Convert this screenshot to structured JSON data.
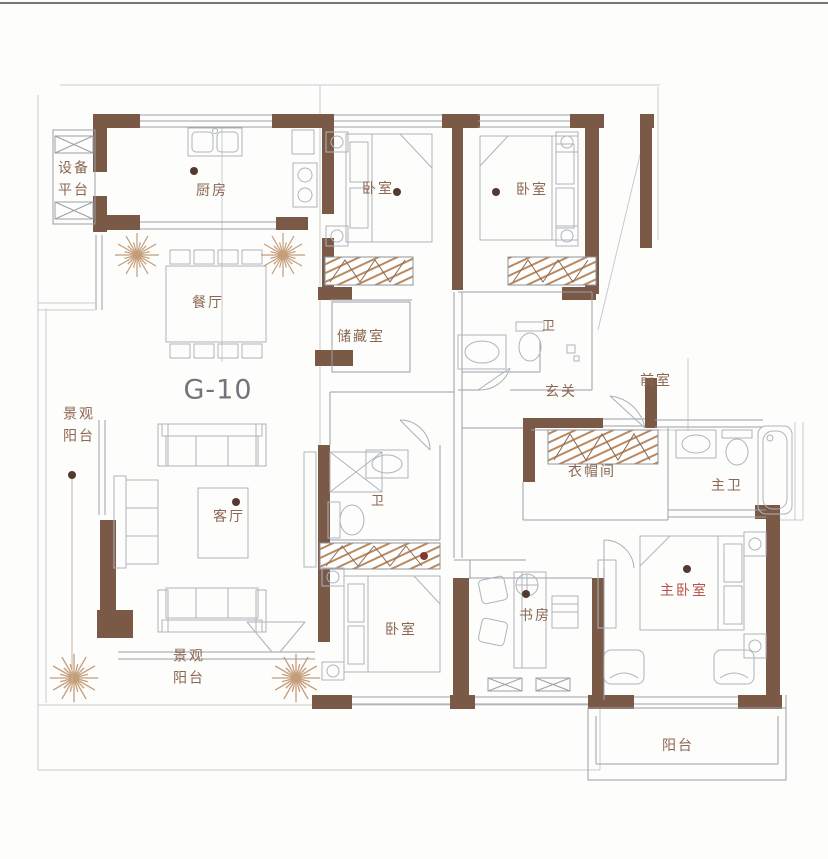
{
  "title": "G-10",
  "rooms": {
    "equipment_platform": "设备\n平台",
    "kitchen": "厨房",
    "bedroom_top_left": "卧室",
    "bedroom_top_right": "卧室",
    "dining_room": "餐厅",
    "storage_room": "储藏室",
    "bath_upper": "卫",
    "entry_hall": "玄关",
    "front_room": "前室",
    "landscape_balcony_left": "景观\n阳台",
    "living_room": "客厅",
    "bath_middle": "卫",
    "cloakroom": "衣帽间",
    "master_bath": "主卫",
    "study": "书房",
    "bedroom_bottom": "卧室",
    "master_bedroom": "主卧室",
    "landscape_balcony_bottom": "景观\n阳台",
    "balcony": "阳台"
  },
  "colors": {
    "wall": "#7a5a47",
    "furniture_line": "#aeb4bd",
    "structure_line": "#8d949d",
    "hatch": "#b98a60",
    "label": "#8a6752",
    "label_accent": "#b8524a",
    "unit_label": "#73737a",
    "dot": "#53392f",
    "plant": "#c49d79",
    "background": "#ffffff"
  },
  "icons": {
    "plant_icon": "✳",
    "lamp_dot_icon": "●"
  }
}
